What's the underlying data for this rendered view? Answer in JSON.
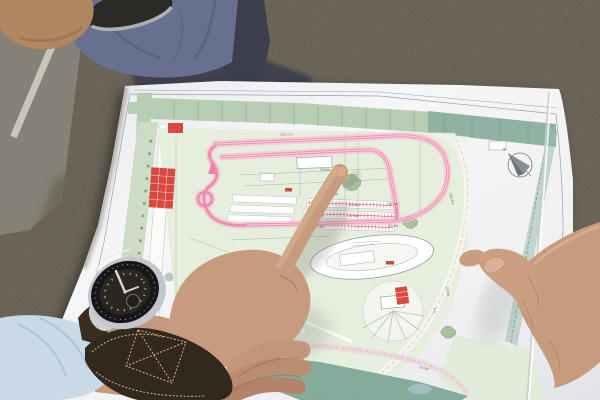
{
  "scene": {
    "subject": "photo of hands pointing at a printed race-track site plan",
    "compass_label": "N"
  },
  "colors": {
    "gravel": "#615b4d",
    "asphalt": "#8b887e",
    "paper_white": "#f3f3f5",
    "field_green": "#e6eedd",
    "strip_green": "#ccdcc6",
    "band_light_green": "#b7cdb4",
    "band_dark_teal": "#8fb2a3",
    "water_teal": "#85ab9c",
    "track_pink": "#ef82aa",
    "track_pink_light": "#f9bcd0",
    "building_red": "#d84a40",
    "shirt_blue": "#68708f",
    "jeans_navy": "#3e4150",
    "cuff_blue": "#c9d9e8",
    "strap_brown": "#33281e",
    "stitch_cream": "#d6c69c",
    "skin": "#c79c7e"
  },
  "map": {
    "labels": [
      {
        "text": "382.0m"
      },
      {
        "text": "73.0m"
      },
      {
        "text": "23.5m"
      },
      {
        "text": "27.5m"
      },
      {
        "text": "25.5m"
      },
      {
        "text": "41.5m"
      },
      {
        "text": "37.5m"
      },
      {
        "text": "37.5m"
      },
      {
        "text": "25.5m"
      },
      {
        "text": "150.5m"
      },
      {
        "text": "13.0m"
      },
      {
        "text": "9.5"
      },
      {
        "text": "53.5m"
      }
    ]
  }
}
